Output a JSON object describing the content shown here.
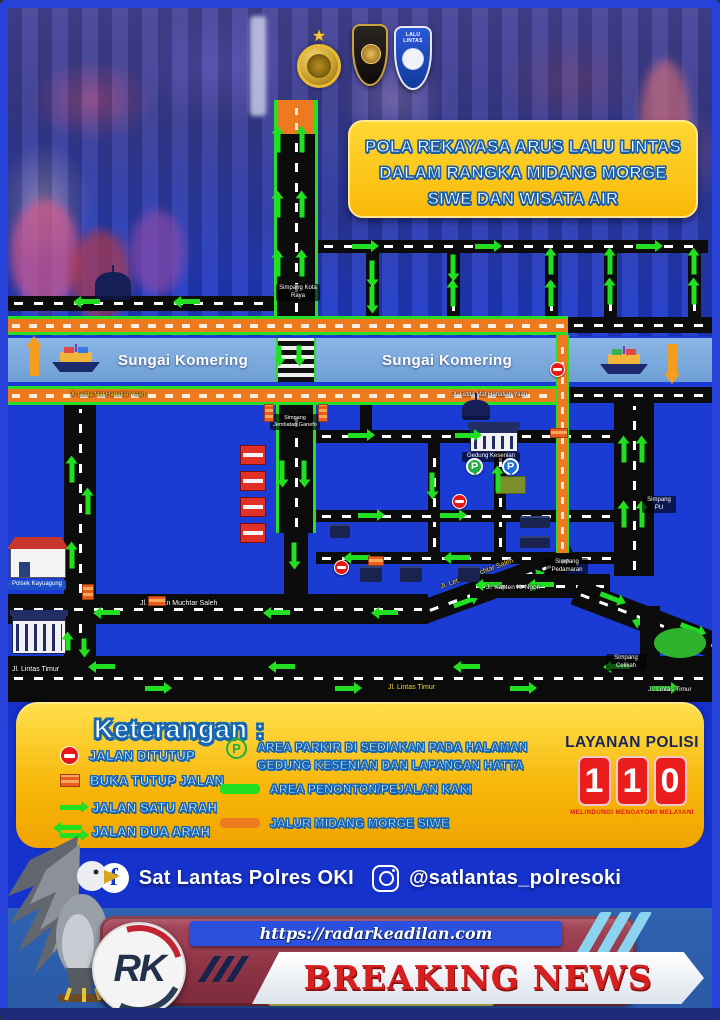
{
  "header": {
    "title_line1": "POLA REKAYASA ARUS LALU LINTAS",
    "title_line2": "DALAM RANGKA MIDANG MORGE",
    "title_line3": "SIWE DAN WISATA AIR",
    "badge_label": "LALU LINTAS"
  },
  "icons": {
    "star": "★",
    "facebook": "f",
    "parking": "P"
  },
  "map": {
    "river_name": "Sungai Komering",
    "labels": {
      "polsek": "Polsek Kayuagung",
      "gedung_kesenian": "Gedung Kesenian",
      "jalan_muchtar": "Jl. Letnan Muchtar Saleh",
      "jalan_kapten": "Jl. Kapten K. Ngoh",
      "jalan_lintas": "Jl. Lintas Timur",
      "jalan_hanafiah": "Jl. Letda Mat Hanafiah Yaan",
      "simpang_kota": "Simpang Kota Raya",
      "simpang_jembatan": "Simpang Jembatan Ganefo",
      "simpang_pedamaran": "Simpang Pedamaran",
      "simpang_celikah": "Simpang Celikah",
      "simpang_pu": "Simpang PU"
    }
  },
  "legend": {
    "title": "Keterangan :",
    "items_left": [
      {
        "icon": "no-entry-icon",
        "label": "JALAN DITUTUP"
      },
      {
        "icon": "open-close-road-icon",
        "label": "BUKA TUTUP JALAN"
      },
      {
        "icon": "one-way-arrow-icon",
        "label": "JALAN SATU ARAH"
      },
      {
        "icon": "two-way-arrow-icon",
        "label": "JALAN DUA ARAH"
      }
    ],
    "items_right": [
      {
        "icon": "parking-icon",
        "label": "AREA PARKIR DI SEDIAKAN PADA HALAMAN GEDUNG KESENIAN DAN LAPANGAN HATTA"
      },
      {
        "icon": "spectator-area-icon",
        "label": "AREA PENONTON/PEJALAN KAKI"
      },
      {
        "icon": "midang-route-icon",
        "label": "JALUR MIDANG MORGE SIWE"
      }
    ]
  },
  "police": {
    "title": "LAYANAN POLISI",
    "digits": [
      "1",
      "1",
      "0"
    ],
    "tagline": "MELINDUNGI MENGAYOMI MELAYANI"
  },
  "social": {
    "facebook_label": "Sat Lantas Polres OKI",
    "instagram_label": "@satlantas_polresoki"
  },
  "news": {
    "url": "https://radarkeadilan.com",
    "logo": "RK",
    "headline": "BREAKING NEWS"
  },
  "colors": {
    "map_blue": "#1b3cd4",
    "route_orange": "#ee7a20",
    "arrow_green": "#22df22",
    "river_blue": "#7fa9dc",
    "panel_yellow": "#f7b60a",
    "police_red": "#ea1c1c",
    "news_red": "#d81f1f",
    "maroon": "#8c3344"
  }
}
